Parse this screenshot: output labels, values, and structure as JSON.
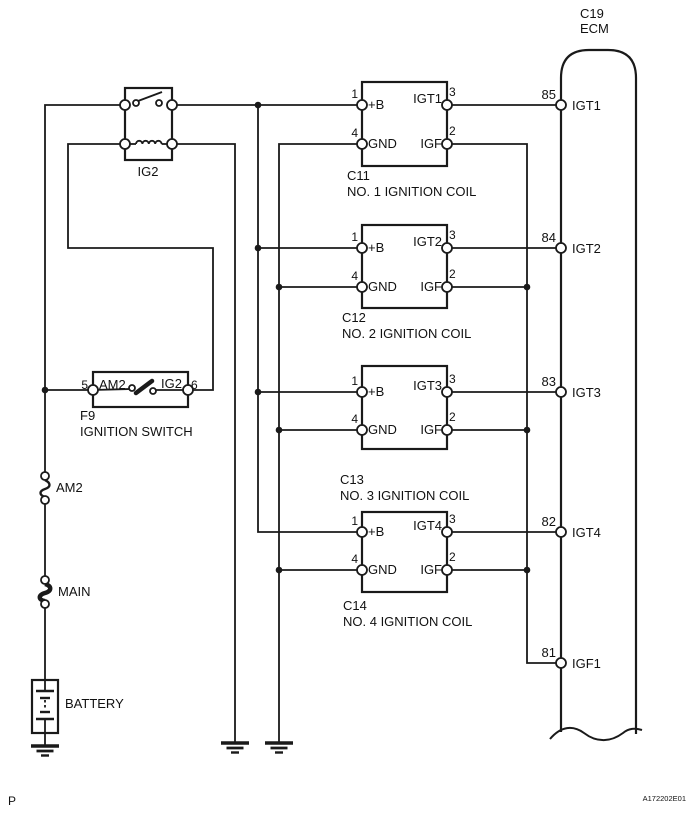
{
  "footer": {
    "page_marker": "P",
    "doc_id": "A172202E01"
  },
  "ecm": {
    "connector_id": "C19",
    "name": "ECM",
    "pins": [
      {
        "terminal": "85",
        "signal": "IGT1"
      },
      {
        "terminal": "84",
        "signal": "IGT2"
      },
      {
        "terminal": "83",
        "signal": "IGT3"
      },
      {
        "terminal": "82",
        "signal": "IGT4"
      },
      {
        "terminal": "81",
        "signal": "IGF1"
      }
    ]
  },
  "relay": {
    "name": "IG2"
  },
  "ignition_switch": {
    "connector_id": "F9",
    "name": "IGNITION SWITCH",
    "pin_left_num": "5",
    "contact_left": "AM2",
    "contact_right": "IG2",
    "pin_right_num": "6"
  },
  "fuse_am2": {
    "label": "AM2"
  },
  "fusible_link_main": {
    "label": "MAIN"
  },
  "battery": {
    "label": "BATTERY"
  },
  "coils": [
    {
      "connector_id": "C11",
      "name": "NO. 1 IGNITION COIL",
      "pin_b_num": "1",
      "pin_b": "+B",
      "pin_igt": "IGT1",
      "pin_igt_num": "3",
      "pin_gnd_num": "4",
      "pin_gnd": "GND",
      "pin_igf": "IGF",
      "pin_igf_num": "2"
    },
    {
      "connector_id": "C12",
      "name": "NO. 2 IGNITION COIL",
      "pin_b_num": "1",
      "pin_b": "+B",
      "pin_igt": "IGT2",
      "pin_igt_num": "3",
      "pin_gnd_num": "4",
      "pin_gnd": "GND",
      "pin_igf": "IGF",
      "pin_igf_num": "2"
    },
    {
      "connector_id": "C13",
      "name": "NO. 3 IGNITION COIL",
      "pin_b_num": "1",
      "pin_b": "+B",
      "pin_igt": "IGT3",
      "pin_igt_num": "3",
      "pin_gnd_num": "4",
      "pin_gnd": "GND",
      "pin_igf": "IGF",
      "pin_igf_num": "2"
    },
    {
      "connector_id": "C14",
      "name": "NO. 4 IGNITION COIL",
      "pin_b_num": "1",
      "pin_b": "+B",
      "pin_igt": "IGT4",
      "pin_igt_num": "3",
      "pin_gnd_num": "4",
      "pin_gnd": "GND",
      "pin_igf": "IGF",
      "pin_igf_num": "2"
    }
  ],
  "colors": {
    "wire": "#1a1a1a",
    "background": "#ffffff"
  }
}
